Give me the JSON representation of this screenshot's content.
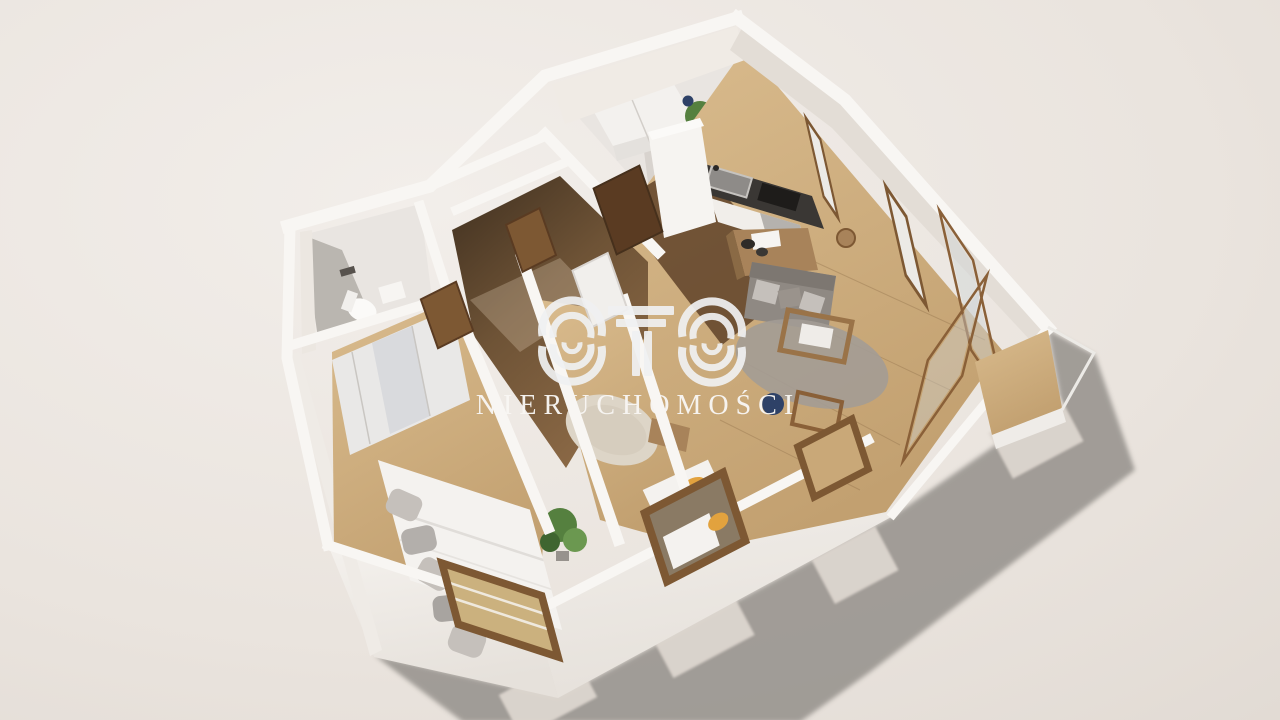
{
  "watermark": {
    "logo_text": "OTO",
    "subtitle": "NIERUCHOMOŚCI"
  },
  "scene": {
    "description": "3D axonometric render of a furnished apartment floor plan on a beige backdrop, sunlight casting a long shadow to the lower right",
    "rooms": [
      {
        "id": "wc",
        "furniture": [
          "toilet",
          "washbasin"
        ]
      },
      {
        "id": "entry-hall",
        "furniture": [
          "white-wardrobe",
          "arc-floor-lamp",
          "leaning-mirror",
          "potted-plant",
          "blue-vase"
        ]
      },
      {
        "id": "hallway",
        "furniture": [
          "wooden-doors",
          "dark-wood-floor"
        ]
      },
      {
        "id": "kitchen",
        "furniture": [
          "counter-with-sink",
          "cooktop",
          "oven",
          "tall-cabinet",
          "island-with-bowls",
          "bar-stool"
        ]
      },
      {
        "id": "living-room",
        "furniture": [
          "gray-sofa",
          "wood-coffee-table",
          "round-rug",
          "navy-pouf",
          "wood-chair",
          "corner-glazing",
          "balcony-deck"
        ]
      },
      {
        "id": "bedroom-1",
        "furniture": [
          "double-bed",
          "gray-pillows",
          "sliding-wardrobe",
          "potted-plant",
          "window"
        ]
      },
      {
        "id": "bedroom-2",
        "furniture": [
          "bed-with-orange-pillow",
          "textured-rug",
          "white-door",
          "window"
        ]
      }
    ]
  },
  "palette": {
    "bg": "#eae4de",
    "bgLight": "#f2eeea",
    "bgDark": "#e0d9d2",
    "shadow": "#8d8984",
    "lightPatch": "#ddd6cf",
    "wallTop": "#f8f6f3",
    "wallFaceLit": "#f2eeea",
    "wallFaceShade": "#e3ddd6",
    "wallFaceDark": "#c6c0ba",
    "floorWhite": "#e9e5e1",
    "woodLight": "#cfae80",
    "woodMid": "#a8835a",
    "woodDark": "#5f462e",
    "doorWood": "#7d5833",
    "doorDark": "#5a3b22",
    "counterDark": "#3a3734",
    "steel": "#9b9894",
    "sofaGray": "#8f8983",
    "pillowLight": "#c5c0bb",
    "rugGray": "#a39c95",
    "rugCream": "#ddd5c7",
    "bedWhite": "#f4f2ef",
    "plantGreen": "#55803f",
    "plantDark": "#3f6530",
    "navy": "#2e4167",
    "orange": "#e2a23e",
    "glass": "#cfd5d8",
    "watermarkText": "#f8f6f3"
  }
}
